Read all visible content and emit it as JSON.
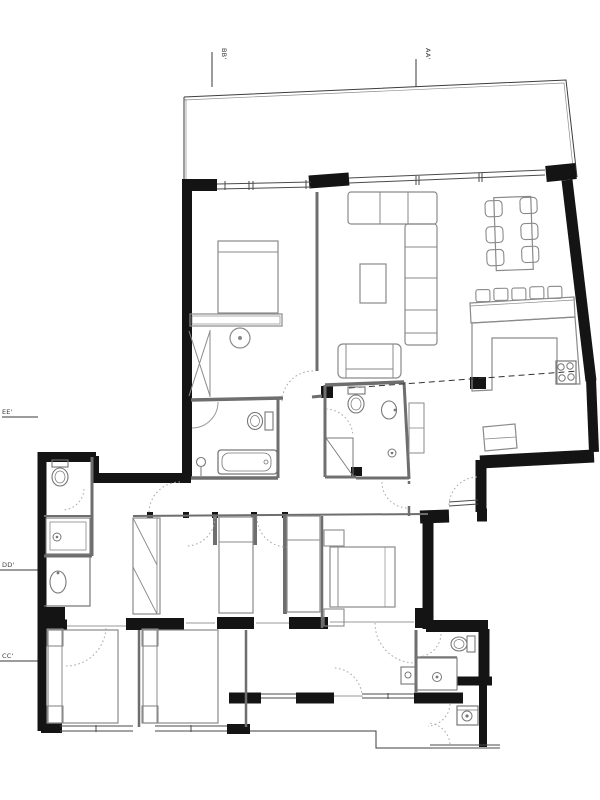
{
  "drawing": {
    "type": "residential apartment floor plan",
    "background": "#ffffff"
  },
  "palette": {
    "wall": "#141414",
    "partition": "#6e6e6e",
    "furniture": "#8a8a8a",
    "fixture": "#777777",
    "window": "#4a4a4a",
    "door_arc": "#a8a8a8",
    "dashed_line": "#333333",
    "section_marks": "#3a3a3a"
  },
  "section_markers": {
    "top": [
      {
        "id": "bb",
        "label": "BB'"
      },
      {
        "id": "aa",
        "label": "AA'"
      }
    ],
    "left": [
      {
        "id": "ee",
        "label": "EE'"
      },
      {
        "id": "dd",
        "label": "DD'"
      },
      {
        "id": "cc",
        "label": "CC'"
      }
    ]
  },
  "rooms": [
    {
      "name": "terrace"
    },
    {
      "name": "master-bedroom"
    },
    {
      "name": "living-room"
    },
    {
      "name": "dining-area"
    },
    {
      "name": "kitchen"
    },
    {
      "name": "hallway"
    },
    {
      "name": "main-bathroom"
    },
    {
      "name": "bathroom-2"
    },
    {
      "name": "small-bathroom"
    },
    {
      "name": "bathroom-3"
    },
    {
      "name": "laundry"
    },
    {
      "name": "entry"
    },
    {
      "name": "bedroom-2"
    },
    {
      "name": "bedroom-3"
    },
    {
      "name": "bedroom-4"
    },
    {
      "name": "bedroom-5"
    },
    {
      "name": "patio"
    }
  ],
  "furniture_symbols": [
    "sectional-sofa",
    "loveseat",
    "coffee-table",
    "dining-table",
    "dining-chair-x6",
    "bar-stool-x5",
    "kitchen-counter",
    "cooktop",
    "refrigerator",
    "double-bed-x3",
    "single-bed-x2",
    "wardrobe",
    "bathtub",
    "shower-x3",
    "toilet-x4",
    "washbasin-x5",
    "washing-machine",
    "desk",
    "vanity-stool"
  ]
}
